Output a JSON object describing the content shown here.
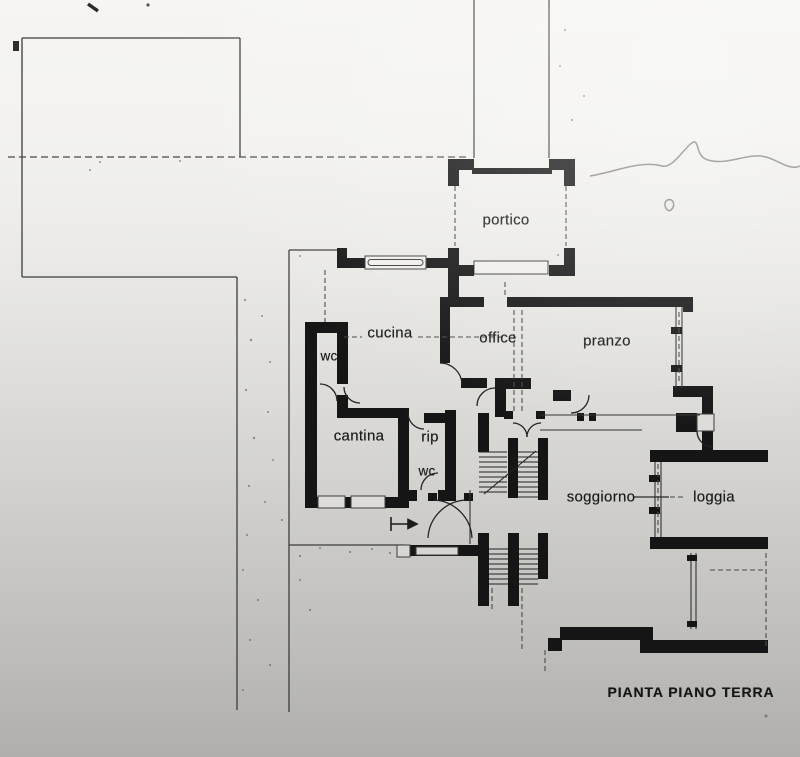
{
  "drawing": {
    "title": "PIANTA PIANO TERRA",
    "type": "architectural floor plan, ground floor"
  },
  "rooms": [
    {
      "id": "portico",
      "label": "portico"
    },
    {
      "id": "cucina",
      "label": "cucina"
    },
    {
      "id": "office",
      "label": "office"
    },
    {
      "id": "pranzo",
      "label": "pranzo"
    },
    {
      "id": "wc-upper",
      "label": "wc"
    },
    {
      "id": "cantina",
      "label": "cantina"
    },
    {
      "id": "rip",
      "label": "rip"
    },
    {
      "id": "wc-lower",
      "label": "wc"
    },
    {
      "id": "soggiorno",
      "label": "soggiorno"
    },
    {
      "id": "loggia",
      "label": "loggia"
    }
  ],
  "colors": {
    "ink": "#151515",
    "thin_line": "#3c3c3c",
    "paper_top": "#f6f5f1",
    "paper_bottom": "#b0afac"
  }
}
